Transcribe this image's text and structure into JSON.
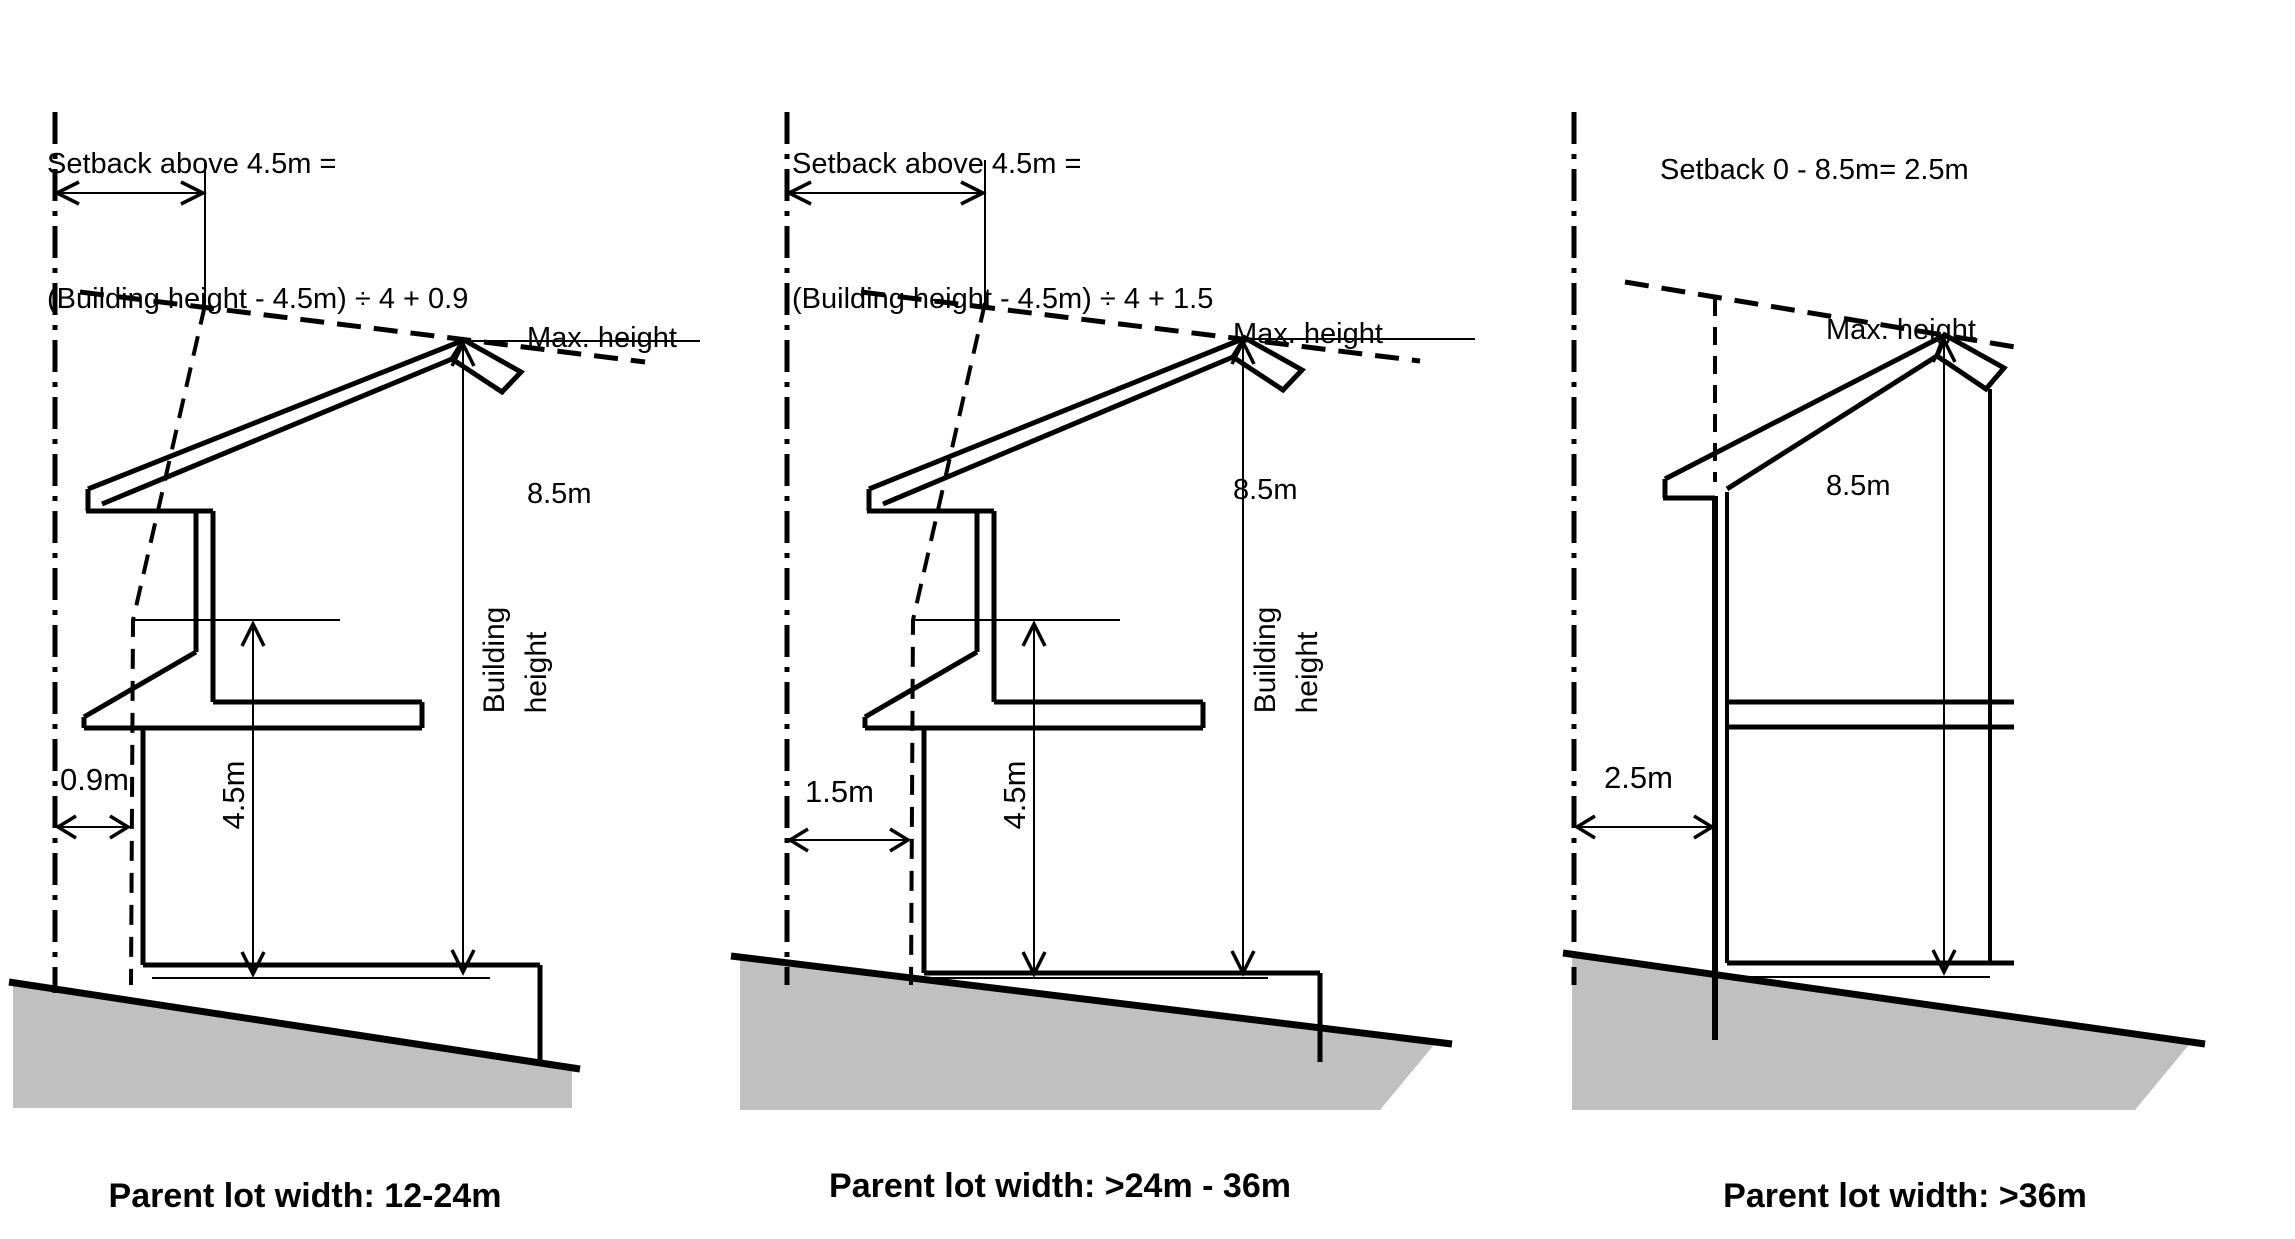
{
  "colors": {
    "line": "#000000",
    "ground_fill": "#c0c0c0",
    "background": "#ffffff"
  },
  "panels": [
    {
      "id": "lot-12-24",
      "title_line1": "Setback above 4.5m =",
      "title_line2": "(Building height - 4.5m) ÷ 4 + 0.9",
      "max_height_line1": "Max. height",
      "max_height_line2": "8.5m",
      "ground_setback_label": "0.9m",
      "level_label": "4.5m",
      "building_height_line1": "Building",
      "building_height_line2": "height",
      "caption": "Parent lot width: 12-24m"
    },
    {
      "id": "lot-24-36",
      "title_line1": "Setback above 4.5m =",
      "title_line2": "(Building height - 4.5m) ÷ 4 + 1.5",
      "max_height_line1": "Max. height",
      "max_height_line2": "8.5m",
      "ground_setback_label": "1.5m",
      "level_label": "4.5m",
      "building_height_line1": "Building",
      "building_height_line2": "height",
      "caption": "Parent lot width: >24m - 36m"
    },
    {
      "id": "lot-over-36",
      "title_line1": "Setback 0 - 8.5m= 2.5m",
      "max_height_line1": "Max. height",
      "max_height_line2": "8.5m",
      "ground_setback_label": "2.5m",
      "caption": "Parent lot width: >36m"
    }
  ]
}
